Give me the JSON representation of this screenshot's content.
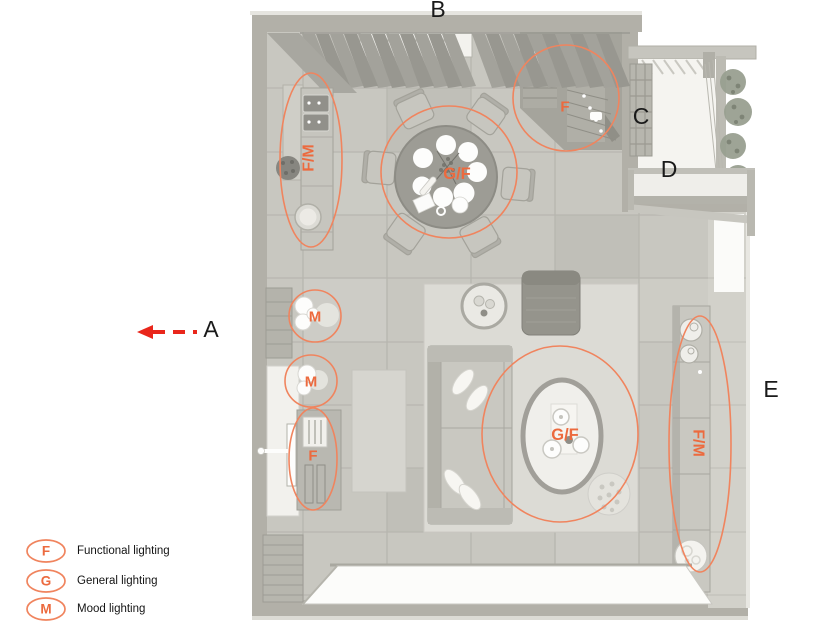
{
  "title": "Lighting plan floor layout",
  "colors": {
    "annotation_stroke": "#f0845e",
    "annotation_text": "#ec6a3e",
    "arrow_red": "#e9261b",
    "callout_text": "#1a1a1a",
    "floor_tile": "#c8c7c0",
    "wall": "#b2b0a8"
  },
  "callouts": {
    "a": {
      "label": "A"
    },
    "b": {
      "label": "B"
    },
    "c": {
      "label": "C"
    },
    "d": {
      "label": "D"
    },
    "e": {
      "label": "E"
    }
  },
  "zones": {
    "kitchen_counter": {
      "label": "F/M"
    },
    "dining_table": {
      "label": "G/F"
    },
    "stairs": {
      "label": "F"
    },
    "wall_lamps_upper": {
      "label": "M"
    },
    "wall_lamps_lower": {
      "label": "M"
    },
    "bar_cabinet": {
      "label": "F"
    },
    "coffee_table": {
      "label": "G/F"
    },
    "sideboard": {
      "label": "F/M"
    }
  },
  "legend": {
    "items": [
      {
        "symbol": "F",
        "label": "Functional lighting"
      },
      {
        "symbol": "G",
        "label": "General lighting"
      },
      {
        "symbol": "M",
        "label": "Mood lighting"
      }
    ]
  }
}
